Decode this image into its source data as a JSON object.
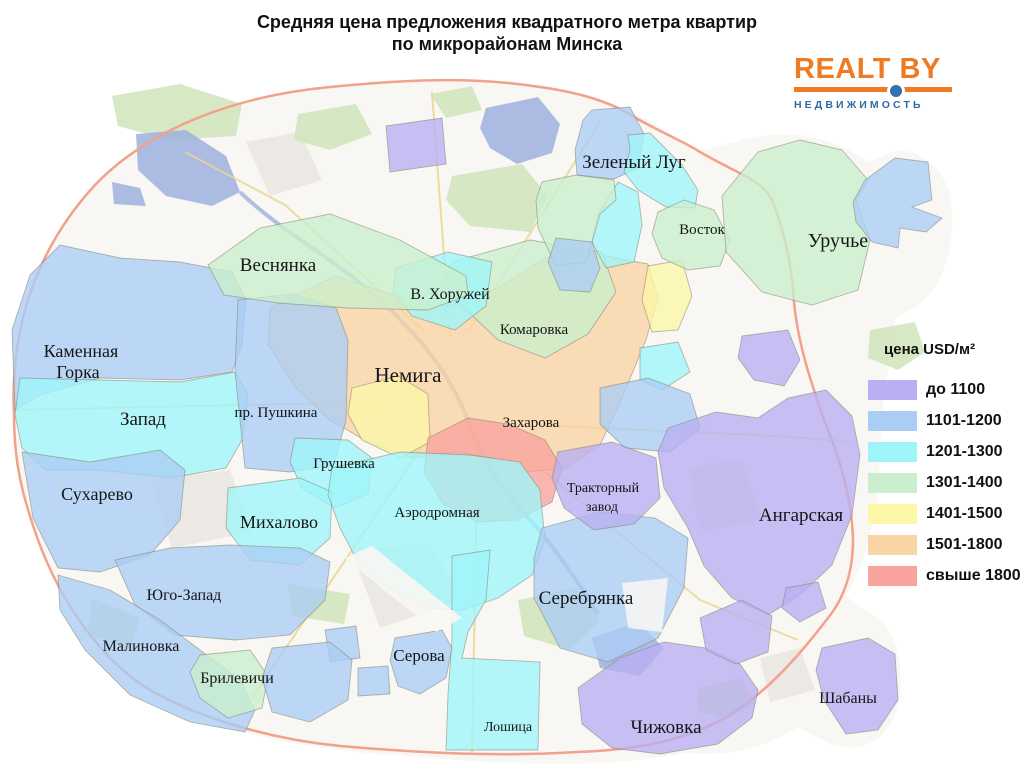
{
  "title": {
    "line1": "Средняя цена предложения квадратного метра квартир",
    "line2": "по микрорайонам Минска"
  },
  "logo": {
    "text": "REALT BY",
    "subtext": "НЕДВИЖИМОСТЬ",
    "text_color": "#f07a22",
    "subtext_color": "#2e6ca6",
    "dot_color": "#3570ad"
  },
  "legend": {
    "title": "цена USD/м²",
    "items": [
      {
        "key": "purple",
        "label": "до 1100",
        "color": "#b8b0f2"
      },
      {
        "key": "blue",
        "label": "1101-1200",
        "color": "#aacdf5"
      },
      {
        "key": "cyan",
        "label": "1201-1300",
        "color": "#9ef6fa"
      },
      {
        "key": "green",
        "label": "1301-1400",
        "color": "#c9efcd"
      },
      {
        "key": "yellow",
        "label": "1401-1500",
        "color": "#fbf7a6"
      },
      {
        "key": "orange",
        "label": "1501-1800",
        "color": "#f9d4a4"
      },
      {
        "key": "red",
        "label": "свыше 1800",
        "color": "#f9a39e"
      }
    ]
  },
  "map": {
    "palette": {
      "base": "#f9f7f3",
      "forest": "#cfe5ba",
      "water": "#9fb0dd",
      "road": "#e9d78f",
      "ring_road": "#f2a18b",
      "border": "#83816e",
      "urban": "#e9e5e0"
    },
    "labels": {
      "zeleny_lug": "Зеленый Луг",
      "vostok": "Восток",
      "uruchye": "Уручье",
      "vesnyanka": "Веснянка",
      "v_khoruzhey": "В. Хоружей",
      "komarovka": "Комаровка",
      "nemiga": "Немига",
      "kamennaya_1": "Каменная",
      "kamennaya_2": "Горка",
      "zapad": "Запад",
      "pr_pushkina": "пр. Пушкина",
      "zakharova": "Захарова",
      "grushevka": "Грушевка",
      "sukharevo": "Сухарево",
      "mikhalovo": "Михалово",
      "aerodromnaya": "Аэродромная",
      "traktorny_1": "Тракторный",
      "traktorny_2": "завод",
      "angarskaya": "Ангарская",
      "yugo_zapad": "Юго-Запад",
      "serebryanka": "Серебрянка",
      "malinovka": "Малиновка",
      "brilevichi": "Брилевичи",
      "serova": "Серова",
      "loshitsa": "Лошица",
      "chizhovka": "Чижовка",
      "shabany": "Шабаны"
    }
  }
}
